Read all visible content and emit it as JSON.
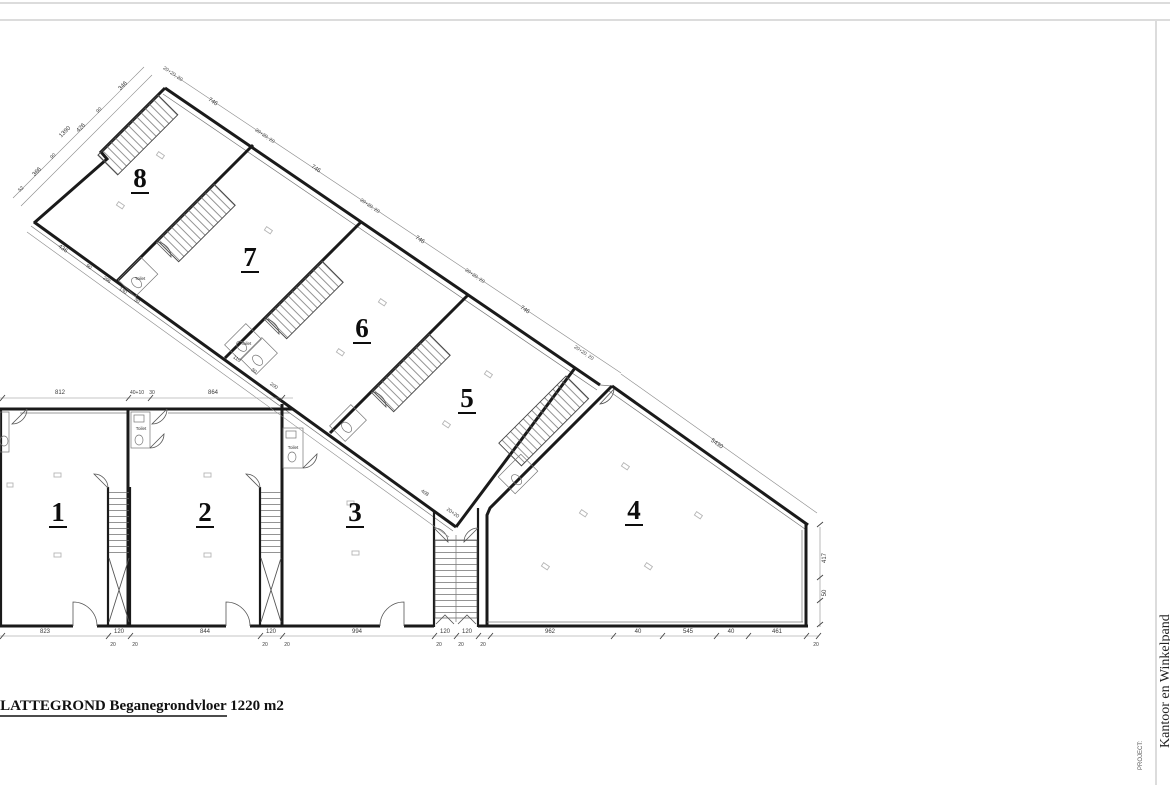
{
  "page": {
    "plan_title": "PLATTEGROND Beganegrondvloer  1220 m2"
  },
  "title_block": {
    "project_label": "PROJECT:",
    "project_name": "Kantoor en Winkelpand"
  },
  "units": {
    "u1": "1",
    "u2": "2",
    "u3": "3",
    "u4": "4",
    "u5": "5",
    "u6": "6",
    "u7": "7",
    "u8": "8"
  },
  "labels": {
    "toilet": "Toilet"
  },
  "colors": {
    "ink": "#1a1a1a",
    "dim_text": "#3a3a3a",
    "faint": "#b5b5b5",
    "frame": "#dcdcdc",
    "paper": "#ffffff"
  },
  "dims": {
    "bottom": [
      "823",
      "120",
      "844",
      "120",
      "994",
      "120",
      "120",
      "962",
      "40",
      "545",
      "40",
      "461"
    ],
    "bottom_sub": "20",
    "top": [
      "812",
      "40+10",
      "30",
      "864"
    ],
    "right": [
      "417",
      "50"
    ],
    "wing_top_wall": "20+20, 20",
    "wing_top_seg": "746",
    "slope": "5430",
    "wing_left": [
      "346",
      "90",
      "426",
      "90",
      "366",
      "52"
    ],
    "wing_left_outer": "1390",
    "wing_b8": [
      "436",
      "90",
      "296",
      "130",
      "30"
    ],
    "wing_b7": [
      "110",
      "30",
      "200"
    ],
    "wing_low": [
      "408",
      "20+20"
    ]
  }
}
